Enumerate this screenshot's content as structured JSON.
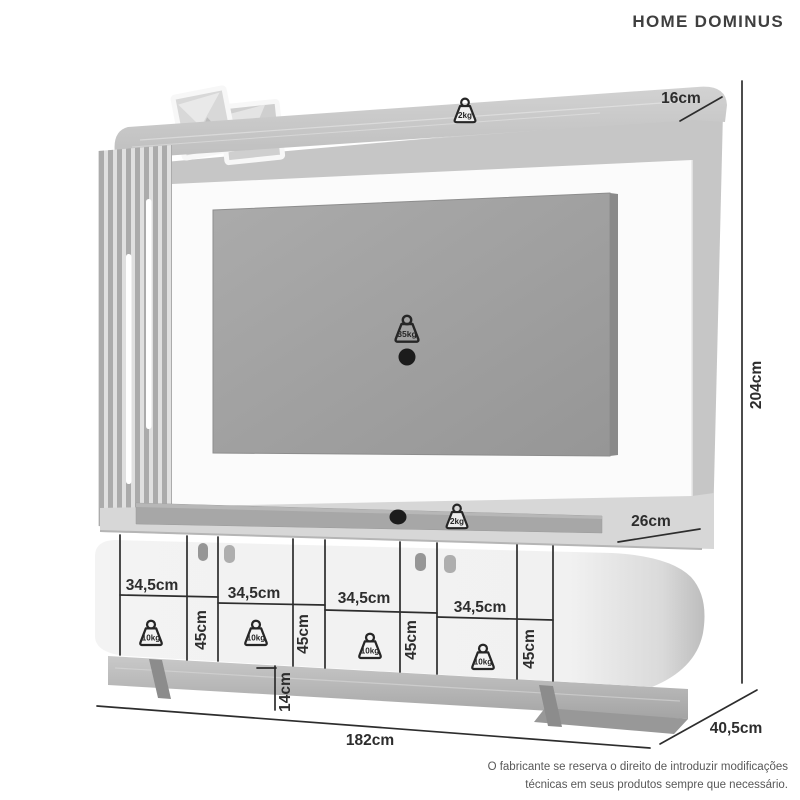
{
  "title": "HOME DOMINUS",
  "dimensions": {
    "top_depth": "16cm",
    "total_height": "204cm",
    "shelf_depth": "26cm",
    "compartment_width": "34,5cm",
    "compartment_height": "45cm",
    "base_height": "14cm",
    "total_width": "182cm",
    "total_depth": "40,5cm"
  },
  "max_weights": {
    "top_panel": "2kg",
    "tv": "35kg",
    "shelf": "2kg",
    "compartment": "10kg"
  },
  "footer": {
    "line1": "O fabricante se reserva o direito de introduzir modificações",
    "line2": "técnicas em seus produtos sempre que necessário."
  },
  "colors": {
    "dimension_line": "#2d2d2d",
    "label_text": "#2d2d2d",
    "panel_white": "#fbfbfb",
    "tv_gray": "#9f9f9f",
    "led_strip": "#ffffff"
  }
}
